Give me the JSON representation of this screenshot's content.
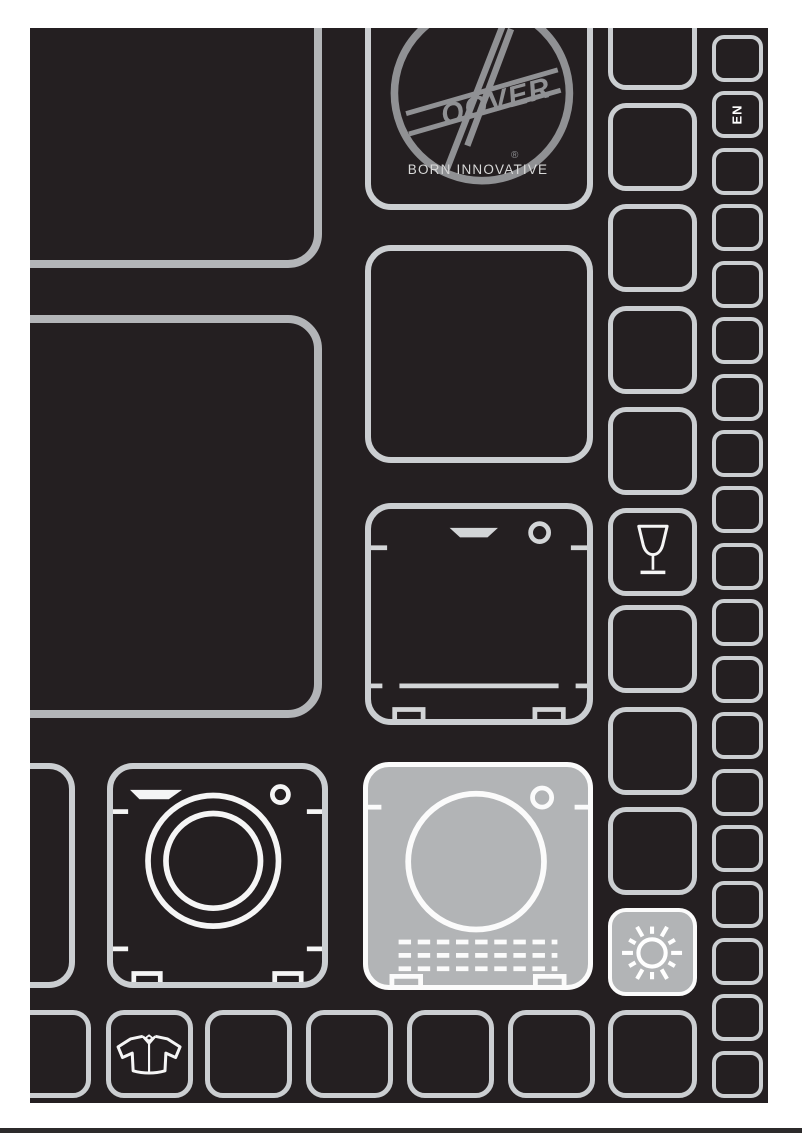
{
  "page": {
    "language_tab": "EN"
  },
  "brand": {
    "logo_script": "OOVER",
    "registered_mark": "®",
    "tagline": "BORN INNOVATIVE"
  },
  "colors": {
    "page-bg": "#ffffff",
    "panel-bg": "#241f21",
    "outline": "#cbced1",
    "outline-strong": "#b3b5b8",
    "fill-light": "#b2b4b6",
    "icon-stroke": "#f5f5f5",
    "detail-gray": "#d3d5d7",
    "logo-gray": "#909194",
    "text-light": "#d8d8d8",
    "footer-line": "#2c2a2b"
  },
  "icons": {
    "hoover_logo": "circle-script-brand-logo",
    "wine_glass": "wine-glass-outline",
    "sun": "sun-with-rays",
    "washing_machine": "front-load-washer-outline",
    "tumble_dryer": "tumble-dryer-filled",
    "dishwasher": "dishwasher-outline",
    "shirt": "shirt-garment-outline"
  }
}
